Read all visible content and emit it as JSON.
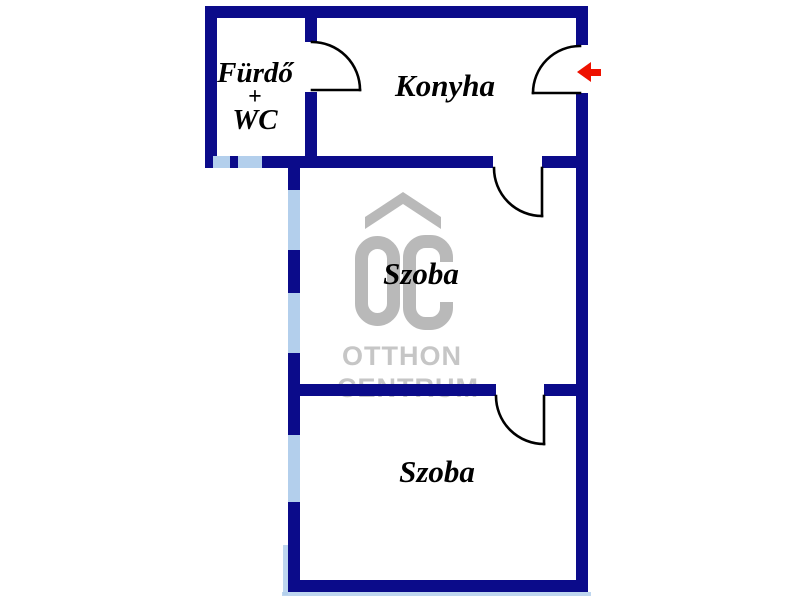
{
  "plan_type": "apartment-floor-plan",
  "rooms": {
    "bathroom": {
      "line1": "Fürdő",
      "line2": "+",
      "line3": "WC"
    },
    "kitchen": {
      "label": "Konyha"
    },
    "room_1": {
      "label": "Szoba"
    },
    "room_2": {
      "label": "Szoba"
    }
  },
  "watermark": {
    "logo": "OC",
    "line1": "OTTHON",
    "line2": "CENTRUM"
  },
  "entrance": {
    "arrow_direction": "left"
  },
  "colors": {
    "wall": "#0b0b8a",
    "window": "#b3cfec",
    "door_swing": "#000000",
    "entrance_arrow": "#ee1100",
    "watermark_logo": "#b9b9b9",
    "watermark_text": "#c6c6c6",
    "background": "#ffffff",
    "label_text": "#000000"
  }
}
